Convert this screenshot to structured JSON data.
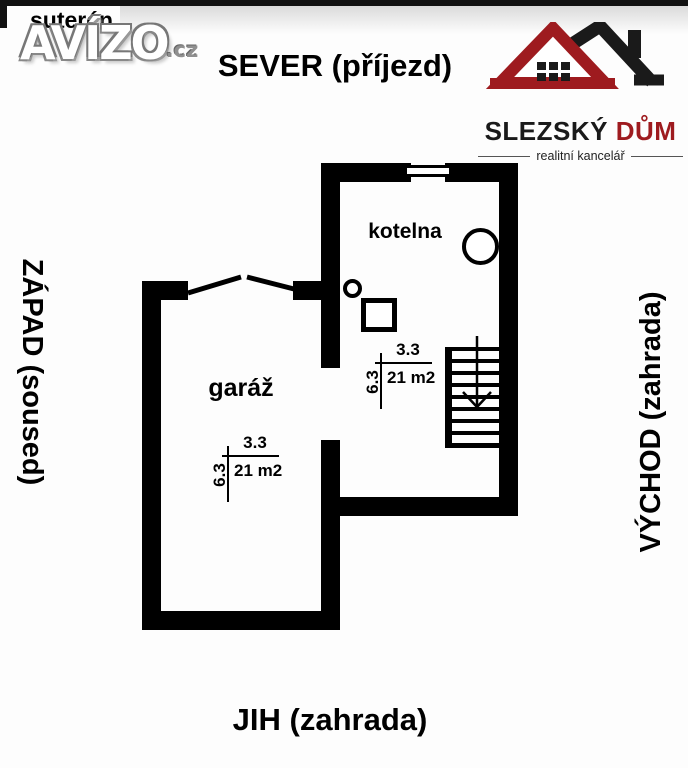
{
  "meta": {
    "floor_label": "suterén"
  },
  "watermark": {
    "brand": "AVÍZO",
    "tld": ".cz"
  },
  "compass": {
    "north": "SEVER (příjezd)",
    "south": "JIH (zahrada)",
    "west": "ZÁPAD (soused)",
    "east": "VÝCHOD (zahrada)"
  },
  "agency": {
    "name_primary": "SLEZSKÝ",
    "name_accent": " DŮM",
    "tagline": "realitní kancelář",
    "accent_color": "#9e1b1f",
    "primary_color": "#1a1a1a"
  },
  "plan": {
    "wall_color": "#000000",
    "rooms": [
      {
        "name": "kotelna",
        "width_m": "3.3",
        "depth_m": "6.3",
        "area": "21 m2"
      },
      {
        "name": "garáž",
        "width_m": "3.3",
        "depth_m": "6.3",
        "area": "21 m2"
      }
    ],
    "icons": {
      "staircase": "stairs-with-down-arrow",
      "boiler": "large-circle-outline",
      "floor_drain": "small-circle-outline",
      "equipment": "square-outline",
      "garage_door": "angled-open-door-lines",
      "window": "double-line-window"
    }
  }
}
